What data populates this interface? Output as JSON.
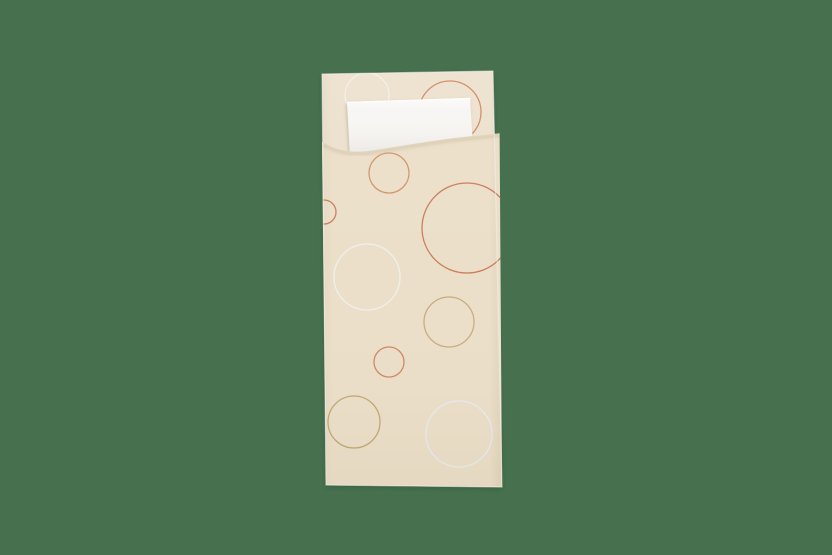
{
  "scene": {
    "description": "Product photo of a cream paper cutlery pouch (bestekzakje) decorated with thin printed circles in terracotta, tan and white, with a folded white napkin tucked into the top opening, photographed on a plain muted-green background",
    "background_color": "#47714e",
    "pouch": {
      "body_color": "#ece1cd",
      "front_color": "#ebdfc9",
      "edge_highlight_color": "#f2f2ee",
      "outline_points": "322,74 493,71 502,487 326,485",
      "front_panel_path": "M322,142 C338,151 352,153.5 372,150.5 C404,145.5 440,139 470,136.2 C481,135.2 491,134.2 499.6,133.2 L502,487 L326,485 Z",
      "flap_curve_path": "M322,142 C338,151 352,153.5 372,150.5 C404,145.5 440,139 470,136.2 C481,135.2 491,134.2 499.6,133.2"
    },
    "napkin": {
      "color": "#f7f6f3",
      "highlight_color": "#fdfdfc",
      "points": "347,102 470,98 473,146 350,157"
    },
    "pattern": {
      "stroke_width": 1.3,
      "circles": [
        {
          "layer": "back",
          "cx": 367,
          "cy": 95,
          "r": 22,
          "color": "#f3efe6"
        },
        {
          "layer": "back",
          "cx": 450,
          "cy": 112,
          "r": 31,
          "color": "#d08a64"
        },
        {
          "layer": "front",
          "cx": 324,
          "cy": 212,
          "r": 12,
          "color": "#cb7e5e"
        },
        {
          "layer": "front",
          "cx": 389,
          "cy": 173,
          "r": 20,
          "color": "#d0956a"
        },
        {
          "layer": "front",
          "cx": 467,
          "cy": 228,
          "r": 45,
          "color": "#cb7c59"
        },
        {
          "layer": "front",
          "cx": 367,
          "cy": 277,
          "r": 33,
          "color": "#f0efec"
        },
        {
          "layer": "front",
          "cx": 449,
          "cy": 322,
          "r": 25,
          "color": "#c6ad7d"
        },
        {
          "layer": "front",
          "cx": 389,
          "cy": 362,
          "r": 15,
          "color": "#cf8762"
        },
        {
          "layer": "front",
          "cx": 354,
          "cy": 422,
          "r": 26,
          "color": "#c2a873"
        },
        {
          "layer": "front",
          "cx": 459,
          "cy": 434,
          "r": 33,
          "color": "#e9ebf0"
        }
      ]
    }
  }
}
